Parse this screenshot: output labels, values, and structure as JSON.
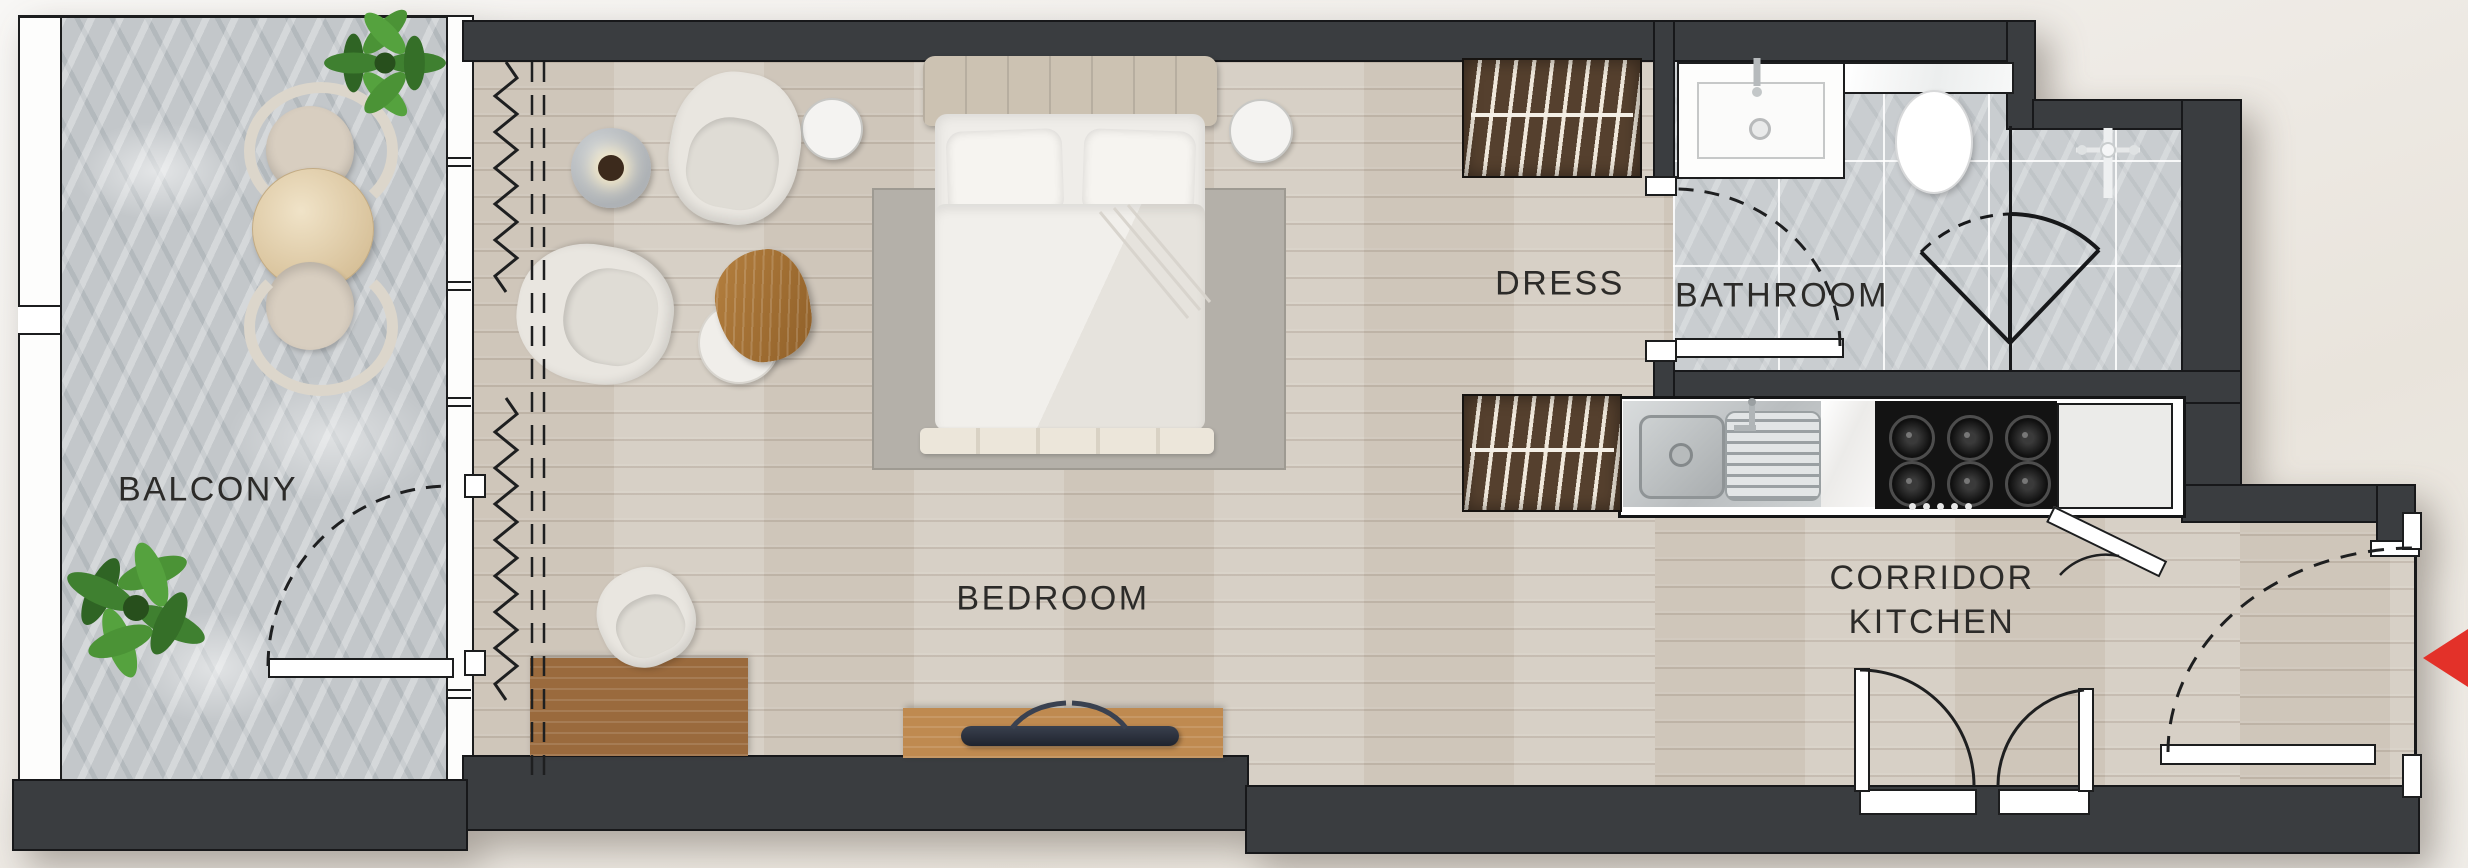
{
  "rooms": {
    "balcony": {
      "label": "BALCONY"
    },
    "bedroom": {
      "label": "BEDROOM"
    },
    "dress": {
      "label": "DRESS"
    },
    "bathroom": {
      "label": "BATHROOM"
    },
    "corridor_kitchen": {
      "label_line1": "CORRIDOR",
      "label_line2": "KITCHEN"
    }
  },
  "entry": {
    "arrow_icon": "entry-arrow-left",
    "arrow_color": "#e33129"
  },
  "colors": {
    "wall": "#3a3d40",
    "wood_floor": "#d5cdc2",
    "balcony_floor": "#c3c7ca",
    "bathroom_floor": "#c9cdd0",
    "wardrobe_wood": "#55402e",
    "furniture_wood": "#9a6a3d",
    "label_text": "#2c2b29",
    "entry_arrow": "#e33129"
  },
  "fixtures": [
    "double-bed",
    "armchair",
    "coffee-table",
    "desk",
    "tv-console",
    "wardrobe",
    "washbasin",
    "toilet",
    "shower",
    "kitchen-sink",
    "gas-hob",
    "balcony-table",
    "balcony-chair",
    "plant"
  ]
}
